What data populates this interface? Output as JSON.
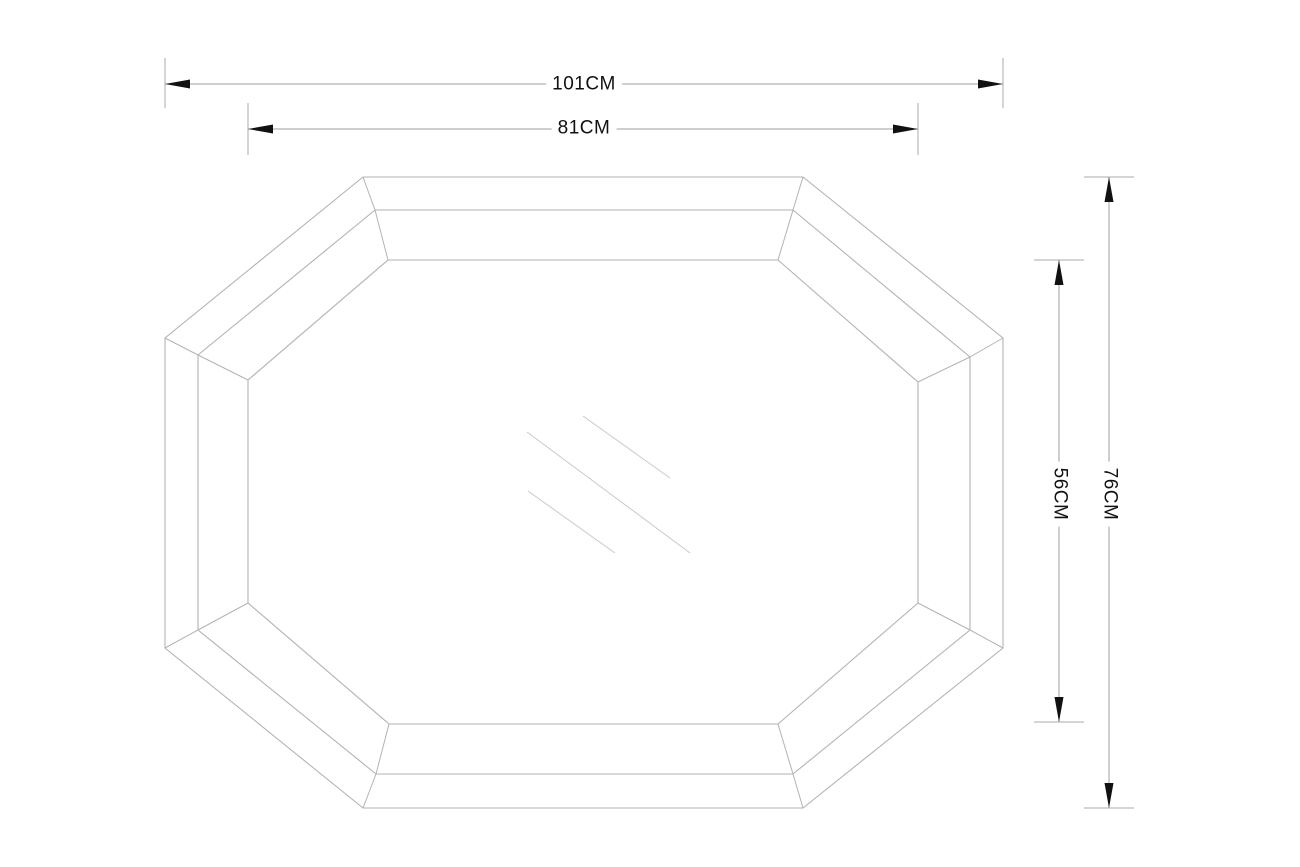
{
  "labels": {
    "outer_width": "101CM",
    "inner_width": "81CM",
    "inner_height": "56CM",
    "outer_height": "76CM"
  },
  "colors": {
    "background": "#ffffff",
    "outline": "#b3b3b3",
    "reflection": "#c9c9c9",
    "dimension_line": "#9f9f9f",
    "extension_line": "#ababab",
    "arrow": "#111111",
    "label_text": "#111111"
  },
  "geometry": {
    "octagons": {
      "outer": [
        [
          363,
          177
        ],
        [
          803,
          177
        ],
        [
          1003,
          338
        ],
        [
          1003,
          648
        ],
        [
          803,
          808
        ],
        [
          363,
          808
        ],
        [
          165,
          648
        ],
        [
          165,
          338
        ]
      ],
      "middle": [
        [
          375,
          210
        ],
        [
          793,
          210
        ],
        [
          970,
          357
        ],
        [
          970,
          630
        ],
        [
          793,
          774
        ],
        [
          376,
          774
        ],
        [
          198,
          630
        ],
        [
          198,
          355
        ]
      ],
      "inner": [
        [
          388,
          260
        ],
        [
          778,
          260
        ],
        [
          918,
          382
        ],
        [
          918,
          603
        ],
        [
          778,
          724
        ],
        [
          389,
          724
        ],
        [
          248,
          603
        ],
        [
          248,
          380
        ]
      ]
    },
    "reflection_lines": [
      [
        583,
        416,
        670,
        478
      ],
      [
        527,
        432,
        690,
        553
      ],
      [
        528,
        491,
        615,
        553
      ]
    ],
    "dimensions": [
      {
        "name": "outer-width",
        "orientation": "h",
        "line": [
          165,
          84,
          1003,
          84
        ],
        "ext": [
          [
            165,
            58,
            165,
            108
          ],
          [
            1003,
            58,
            1003,
            108
          ]
        ]
      },
      {
        "name": "inner-width",
        "orientation": "h",
        "line": [
          248,
          129,
          918,
          129
        ],
        "ext": [
          [
            248,
            103,
            248,
            155
          ],
          [
            918,
            103,
            918,
            155
          ]
        ]
      },
      {
        "name": "inner-height",
        "orientation": "v",
        "line": [
          1059,
          260,
          1059,
          722
        ],
        "ext": [
          [
            1034,
            260,
            1084,
            260
          ],
          [
            1034,
            722,
            1084,
            722
          ]
        ]
      },
      {
        "name": "outer-height",
        "orientation": "v",
        "line": [
          1109,
          177,
          1109,
          808
        ],
        "ext": [
          [
            1084,
            177,
            1134,
            177
          ],
          [
            1084,
            808,
            1134,
            808
          ]
        ]
      }
    ],
    "arrow": {
      "length": 25,
      "half_width": 4.5
    }
  }
}
